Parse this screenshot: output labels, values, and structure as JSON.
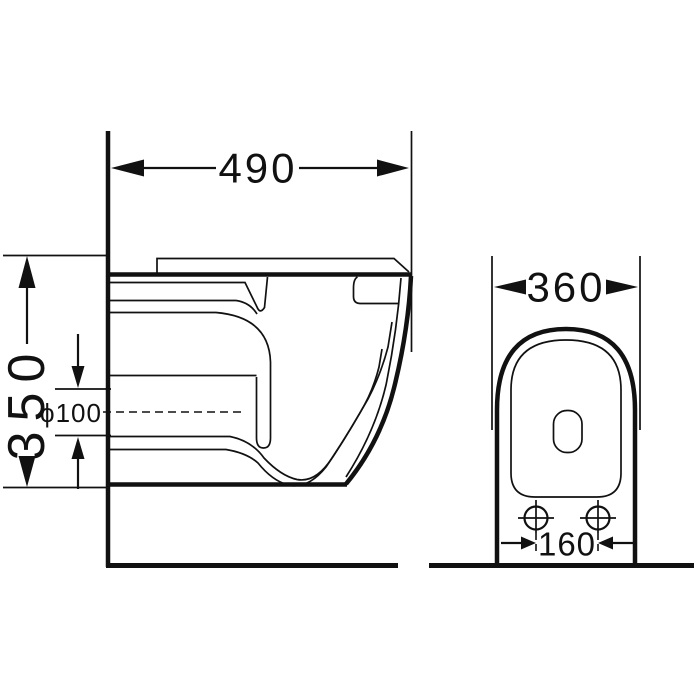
{
  "page": {
    "background_color": "#ffffff",
    "line_color": "#111111",
    "description_of_content": "black and white technical dimension drawing, side view and front view of a wall-hung toilet"
  },
  "drawing": {
    "side_view": {
      "depth_dimension": "490",
      "height_dimension": "350",
      "drain_dimension": "ϕ100"
    },
    "front_view": {
      "width_dimension": "360",
      "bolt_spacing_dimension": "160"
    }
  }
}
